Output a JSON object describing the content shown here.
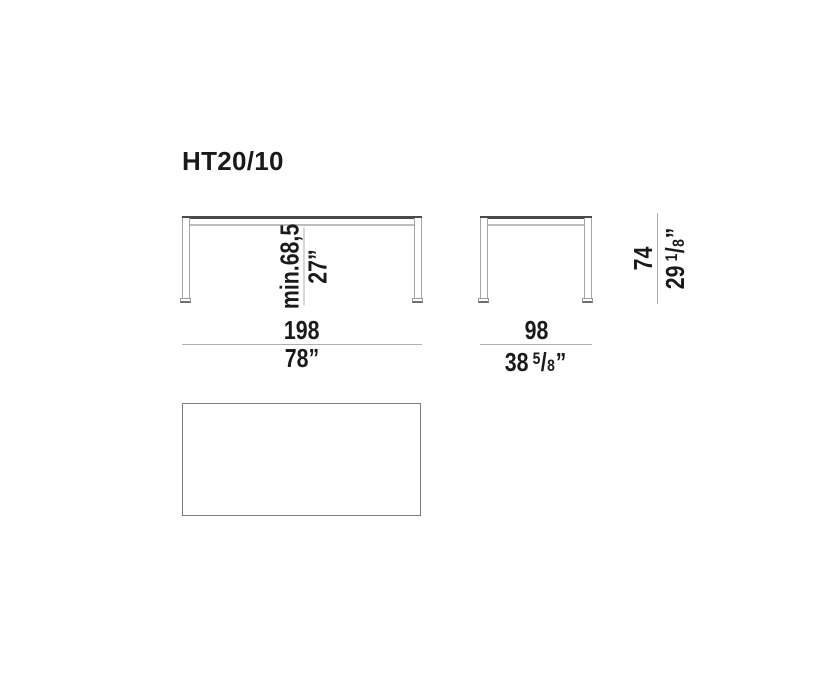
{
  "title": "HT20/10",
  "front_view": {
    "clearance_metric": "min.68,5",
    "clearance_imperial": "27”",
    "width_metric": "198",
    "width_imperial": "78”"
  },
  "side_view": {
    "depth_metric": "98",
    "depth_imperial": {
      "whole": "38",
      "numerator": "5",
      "slash": "/",
      "denominator": "8",
      "quote": "”"
    },
    "height_metric": "74",
    "height_imperial": {
      "whole": "29",
      "numerator": "1",
      "slash": "/",
      "denominator": "8",
      "quote": "”"
    }
  },
  "colors": {
    "background": "#ffffff",
    "text": "#1a1a1a",
    "tabletop_line": "#4a4a4a",
    "secondary_line": "#bcbcbc",
    "leg_outline": "#a6a6a6",
    "dimension_line": "#aeaeae",
    "top_view_border": "#7d7d7d"
  }
}
